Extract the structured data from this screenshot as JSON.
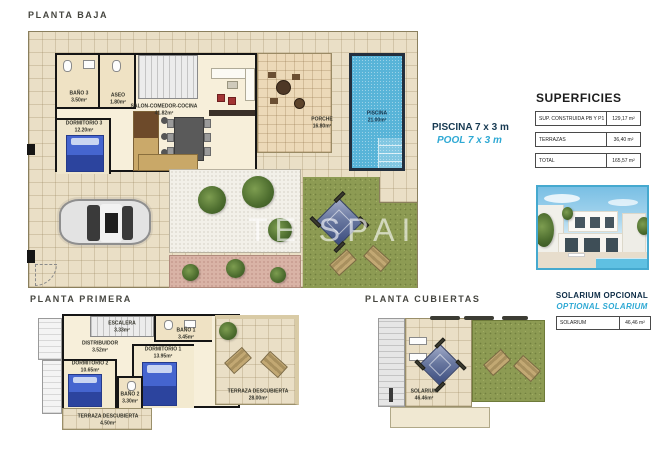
{
  "watermark": "TE SPAIN -",
  "accents": {
    "cyan": "#2fa9d4",
    "navy": "#173a52",
    "photo_border": "#45a9cf"
  },
  "planta_baja": {
    "title": "PLANTA BAJA",
    "rooms": {
      "bano3": {
        "name": "BAÑO 3",
        "area": "3.50m²"
      },
      "aseo": {
        "name": "ASEO",
        "area": "1.80m²"
      },
      "salon": {
        "name": "SALON-COMEDOR-COCINA",
        "area": "41.82m²"
      },
      "dormitorio3": {
        "name": "DORMITORIO 3",
        "area": "12.20m²"
      },
      "porche": {
        "name": "PORCHE",
        "area": "16.80m²"
      },
      "piscina": {
        "name": "PISCINA",
        "area": "21.00m²"
      }
    }
  },
  "pool_note": {
    "es": "PISCINA 7 x 3 m",
    "en": "POOL 7 x 3 m"
  },
  "superficies": {
    "title": "SUPERFICIES",
    "rows": [
      {
        "label": "SUP. CONSTRUIDA PB Y P1",
        "value": "129,17 m²"
      },
      {
        "label": "TERRAZAS",
        "value": "36,40 m²"
      },
      {
        "label": "TOTAL",
        "value": "165,57 m²"
      }
    ]
  },
  "planta_primera": {
    "title": "PLANTA PRIMERA",
    "rooms": {
      "escalera": {
        "name": "ESCALERA",
        "area": "3.33m²"
      },
      "distribuidor": {
        "name": "DISTRIBUIDOR",
        "area": "3.52m²"
      },
      "bano1": {
        "name": "BAÑO 1",
        "area": "3.45m²"
      },
      "dormitorio1": {
        "name": "DORMITORIO 1",
        "area": "13.95m²"
      },
      "dormitorio2": {
        "name": "DORMITORIO 2",
        "area": "10.65m²"
      },
      "bano2": {
        "name": "BAÑO 2",
        "area": "3.30m²"
      },
      "terraza_grande": {
        "name": "TERRAZA DESCUBIERTA",
        "area": "28.00m²"
      },
      "terraza_pequena": {
        "name": "TERRAZA DESCUBIERTA",
        "area": "4.50m²"
      }
    }
  },
  "planta_cubiertas": {
    "title": "PLANTA CUBIERTAS",
    "rooms": {
      "solarium": {
        "name": "SOLARIUM",
        "area": "46.46m²"
      }
    }
  },
  "solarium_opcional": {
    "title_es": "SOLARIUM OPCIONAL",
    "title_en": "OPTIONAL SOLARIUM",
    "rows": [
      {
        "label": "SOLARIUM",
        "value": "46,46 m²"
      }
    ]
  }
}
